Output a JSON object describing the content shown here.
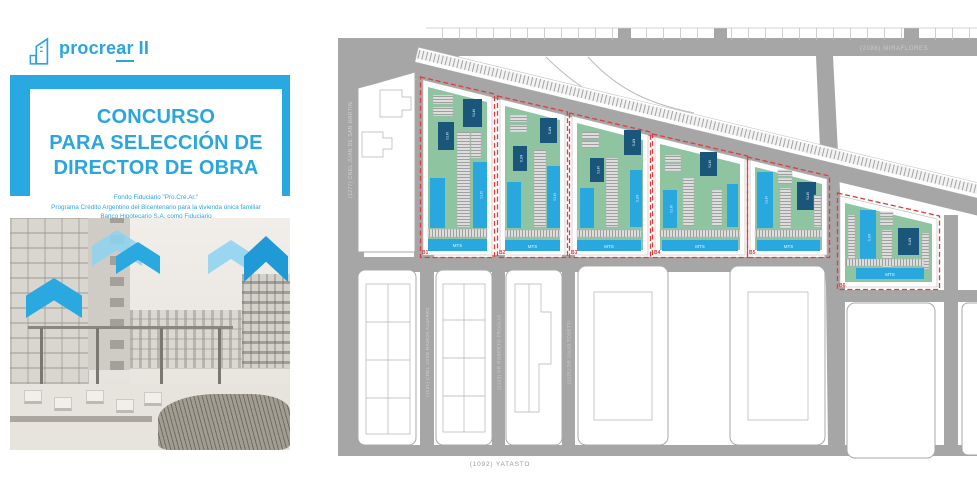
{
  "cover": {
    "logo": {
      "text_pre": "procre",
      "text_underline": "ar",
      "text_suffix": "II"
    },
    "title_lines": [
      "CONCURSO",
      "PARA SELECCIÓN DE",
      "DIRECTOR DE OBRA"
    ],
    "subtitle_lines": [
      "Fondo Fiduciario \"Pro.Cre.Ar.\"",
      "Programa Crédito Argentino del Bicentenario para la vivienda única familiar",
      "Banco Hipotecario S.A. como Fiduciario"
    ],
    "accent_color": "#29a9e1"
  },
  "site_plan": {
    "street_labels": {
      "top": "(2086) MIRAFLORES",
      "left": "(1277) CNEL JUAN DE SAN MARTIN",
      "bottom": "(1092) YATASTO",
      "vertical_1": "(1121) CNEL JOSE RAMON ALVAREZ",
      "vertical_2": "(1123) DR ROBERTO TROGLIO",
      "vertical_3": "(1125) DR JULIO TOSETTI"
    },
    "parcels": [
      {
        "label": "B1"
      },
      {
        "label": "B2"
      },
      {
        "label": "B3"
      },
      {
        "label": "B4"
      },
      {
        "label": "B5"
      },
      {
        "label": "B6"
      }
    ],
    "building_label": "MTS",
    "strip_label": "MTS",
    "colors": {
      "parcel_green": "#8fc4a1",
      "building_blue": "#29a8e0",
      "tower_navy": "#1a567a",
      "boundary_red": "#e23b3c",
      "street_gray": "#a6a6a6"
    }
  }
}
